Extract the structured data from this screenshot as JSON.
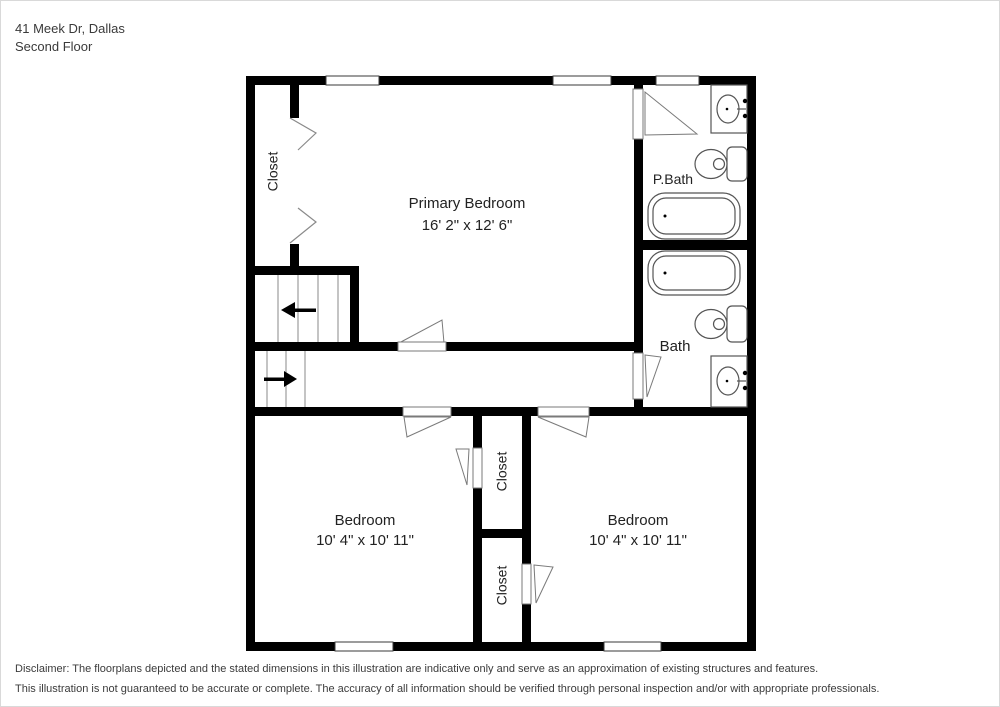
{
  "header": {
    "address": "41 Meek Dr, Dallas",
    "floor": "Second Floor"
  },
  "rooms": {
    "primary_bedroom": {
      "name": "Primary Bedroom",
      "dimensions": "16' 2\" x 12' 6\""
    },
    "pbath": {
      "name": "P.Bath"
    },
    "bath": {
      "name": "Bath"
    },
    "bedroom_left": {
      "name": "Bedroom",
      "dimensions": "10' 4\" x 10' 11\""
    },
    "bedroom_right": {
      "name": "Bedroom",
      "dimensions": "10' 4\" x 10' 11\""
    },
    "closet_left": {
      "name": "Closet"
    },
    "closet_mid_top": {
      "name": "Closet"
    },
    "closet_mid_bottom": {
      "name": "Closet"
    }
  },
  "disclaimer": {
    "line1": "Disclaimer: The floorplans depicted and the stated dimensions in this illustration are indicative only and serve as an approximation of existing structures and features.",
    "line2": "This illustration is not guaranteed to be accurate or complete. The accuracy of all information should be verified through personal inspection and/or with appropriate professionals."
  },
  "icons": {
    "toilet-icon": "oval bowl + rounded tank outline",
    "sink-icon": "vanity rectangle with oval basin and faucet dots",
    "bathtub-icon": "double rounded rectangle with drain dot",
    "window": "white inset rectangle in wall",
    "door": "white leaf with swing wedge",
    "bifold-door-icon": "chevron pair",
    "stairs-arrow-left-icon": "←",
    "stairs-arrow-right-icon": "→"
  },
  "colors": {
    "wall": "#000000",
    "background": "#ffffff",
    "text": "#3a3a3a",
    "label_text": "#222222",
    "fixture_outline": "#555555",
    "stair_line": "#888888"
  }
}
